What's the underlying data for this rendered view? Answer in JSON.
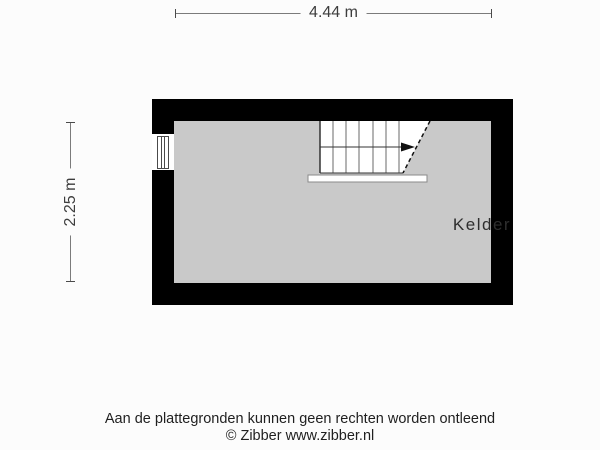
{
  "dimensions": {
    "width_label": "4.44 m",
    "height_label": "2.25 m"
  },
  "rooms": [
    {
      "name": "Kelder"
    }
  ],
  "features": {
    "stairs": {
      "present": true,
      "arrow_direction": "right",
      "treads": 7
    },
    "window": {
      "wall": "left",
      "present": true
    }
  },
  "colors": {
    "wall": "#000000",
    "floor": "#C9C9C9",
    "background": "#FCFCFC",
    "stair_fill": "#FFFFFF"
  },
  "footer": {
    "disclaimer": "Aan de plattegronden kunnen geen rechten worden ontleend",
    "copyright": "© Zibber www.zibber.nl"
  }
}
